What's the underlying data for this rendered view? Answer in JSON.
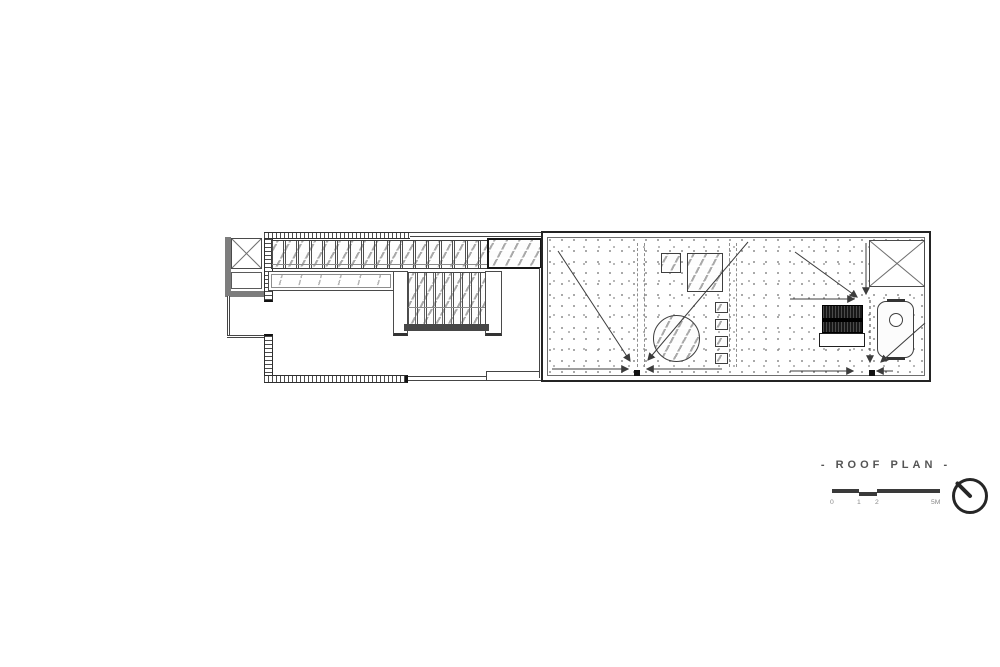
{
  "drawing": {
    "title": "- ROOF PLAN -",
    "scale_bar": {
      "labels": [
        "0",
        "1",
        "2",
        "5M"
      ]
    },
    "icons": {
      "north_arrow": "north-arrow-icon",
      "shaft_cross": "x-cross-icon",
      "drain": "drain-square-icon"
    },
    "colors": {
      "ink": "#3c3c3c",
      "ink_dark": "#1a1a1a",
      "glass_stroke": "#a9a9a9",
      "stipple_dot": "#8f8f8f",
      "equipment_dark": "#181818",
      "title_text": "#545454"
    }
  }
}
